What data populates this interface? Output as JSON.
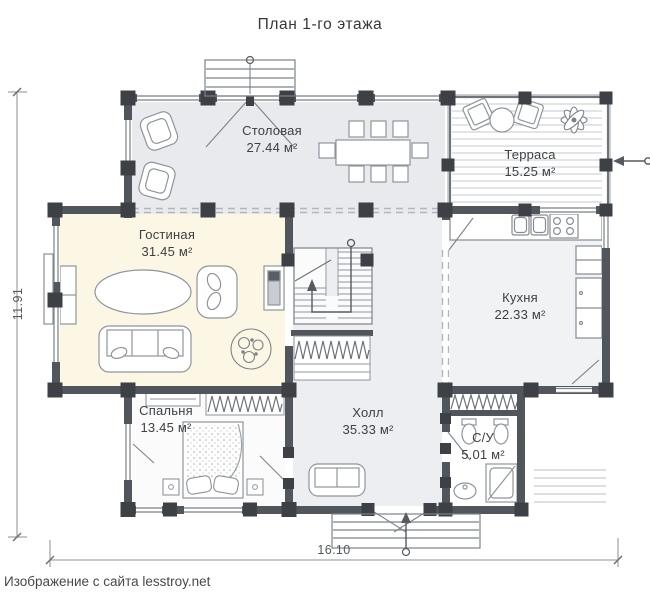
{
  "title": "План 1-го этажа",
  "rooms": {
    "dining": {
      "name": "Столовая",
      "area": "27.44 м²"
    },
    "terrace": {
      "name": "Терраса",
      "area": "15.25 м²"
    },
    "living": {
      "name": "Гостиная",
      "area": "31.45 м²"
    },
    "kitchen": {
      "name": "Кухня",
      "area": "22.33 м²"
    },
    "bedroom": {
      "name": "Спальня",
      "area": "13.45 м²"
    },
    "hall": {
      "name": "Холл",
      "area": "35.33 м²"
    },
    "bathroom": {
      "name": "С/У",
      "area": "5.01 м²"
    }
  },
  "dimensions": {
    "overall_height_m": "11.91",
    "overall_width_m": "16.10"
  },
  "watermark": "Изображение с сайта lesstroy.net",
  "colors": {
    "wall": "#51565c",
    "column": "#3d4146",
    "floor_dining": "#e8eaed",
    "floor_living": "#fbf7e4",
    "floor_hall": "#eceef1",
    "floor_kitchen": "#f1f2f4",
    "floor_bedroom": "#fbfbfc",
    "furniture_line": "#8f959c",
    "label_text": "#3d4145"
  }
}
